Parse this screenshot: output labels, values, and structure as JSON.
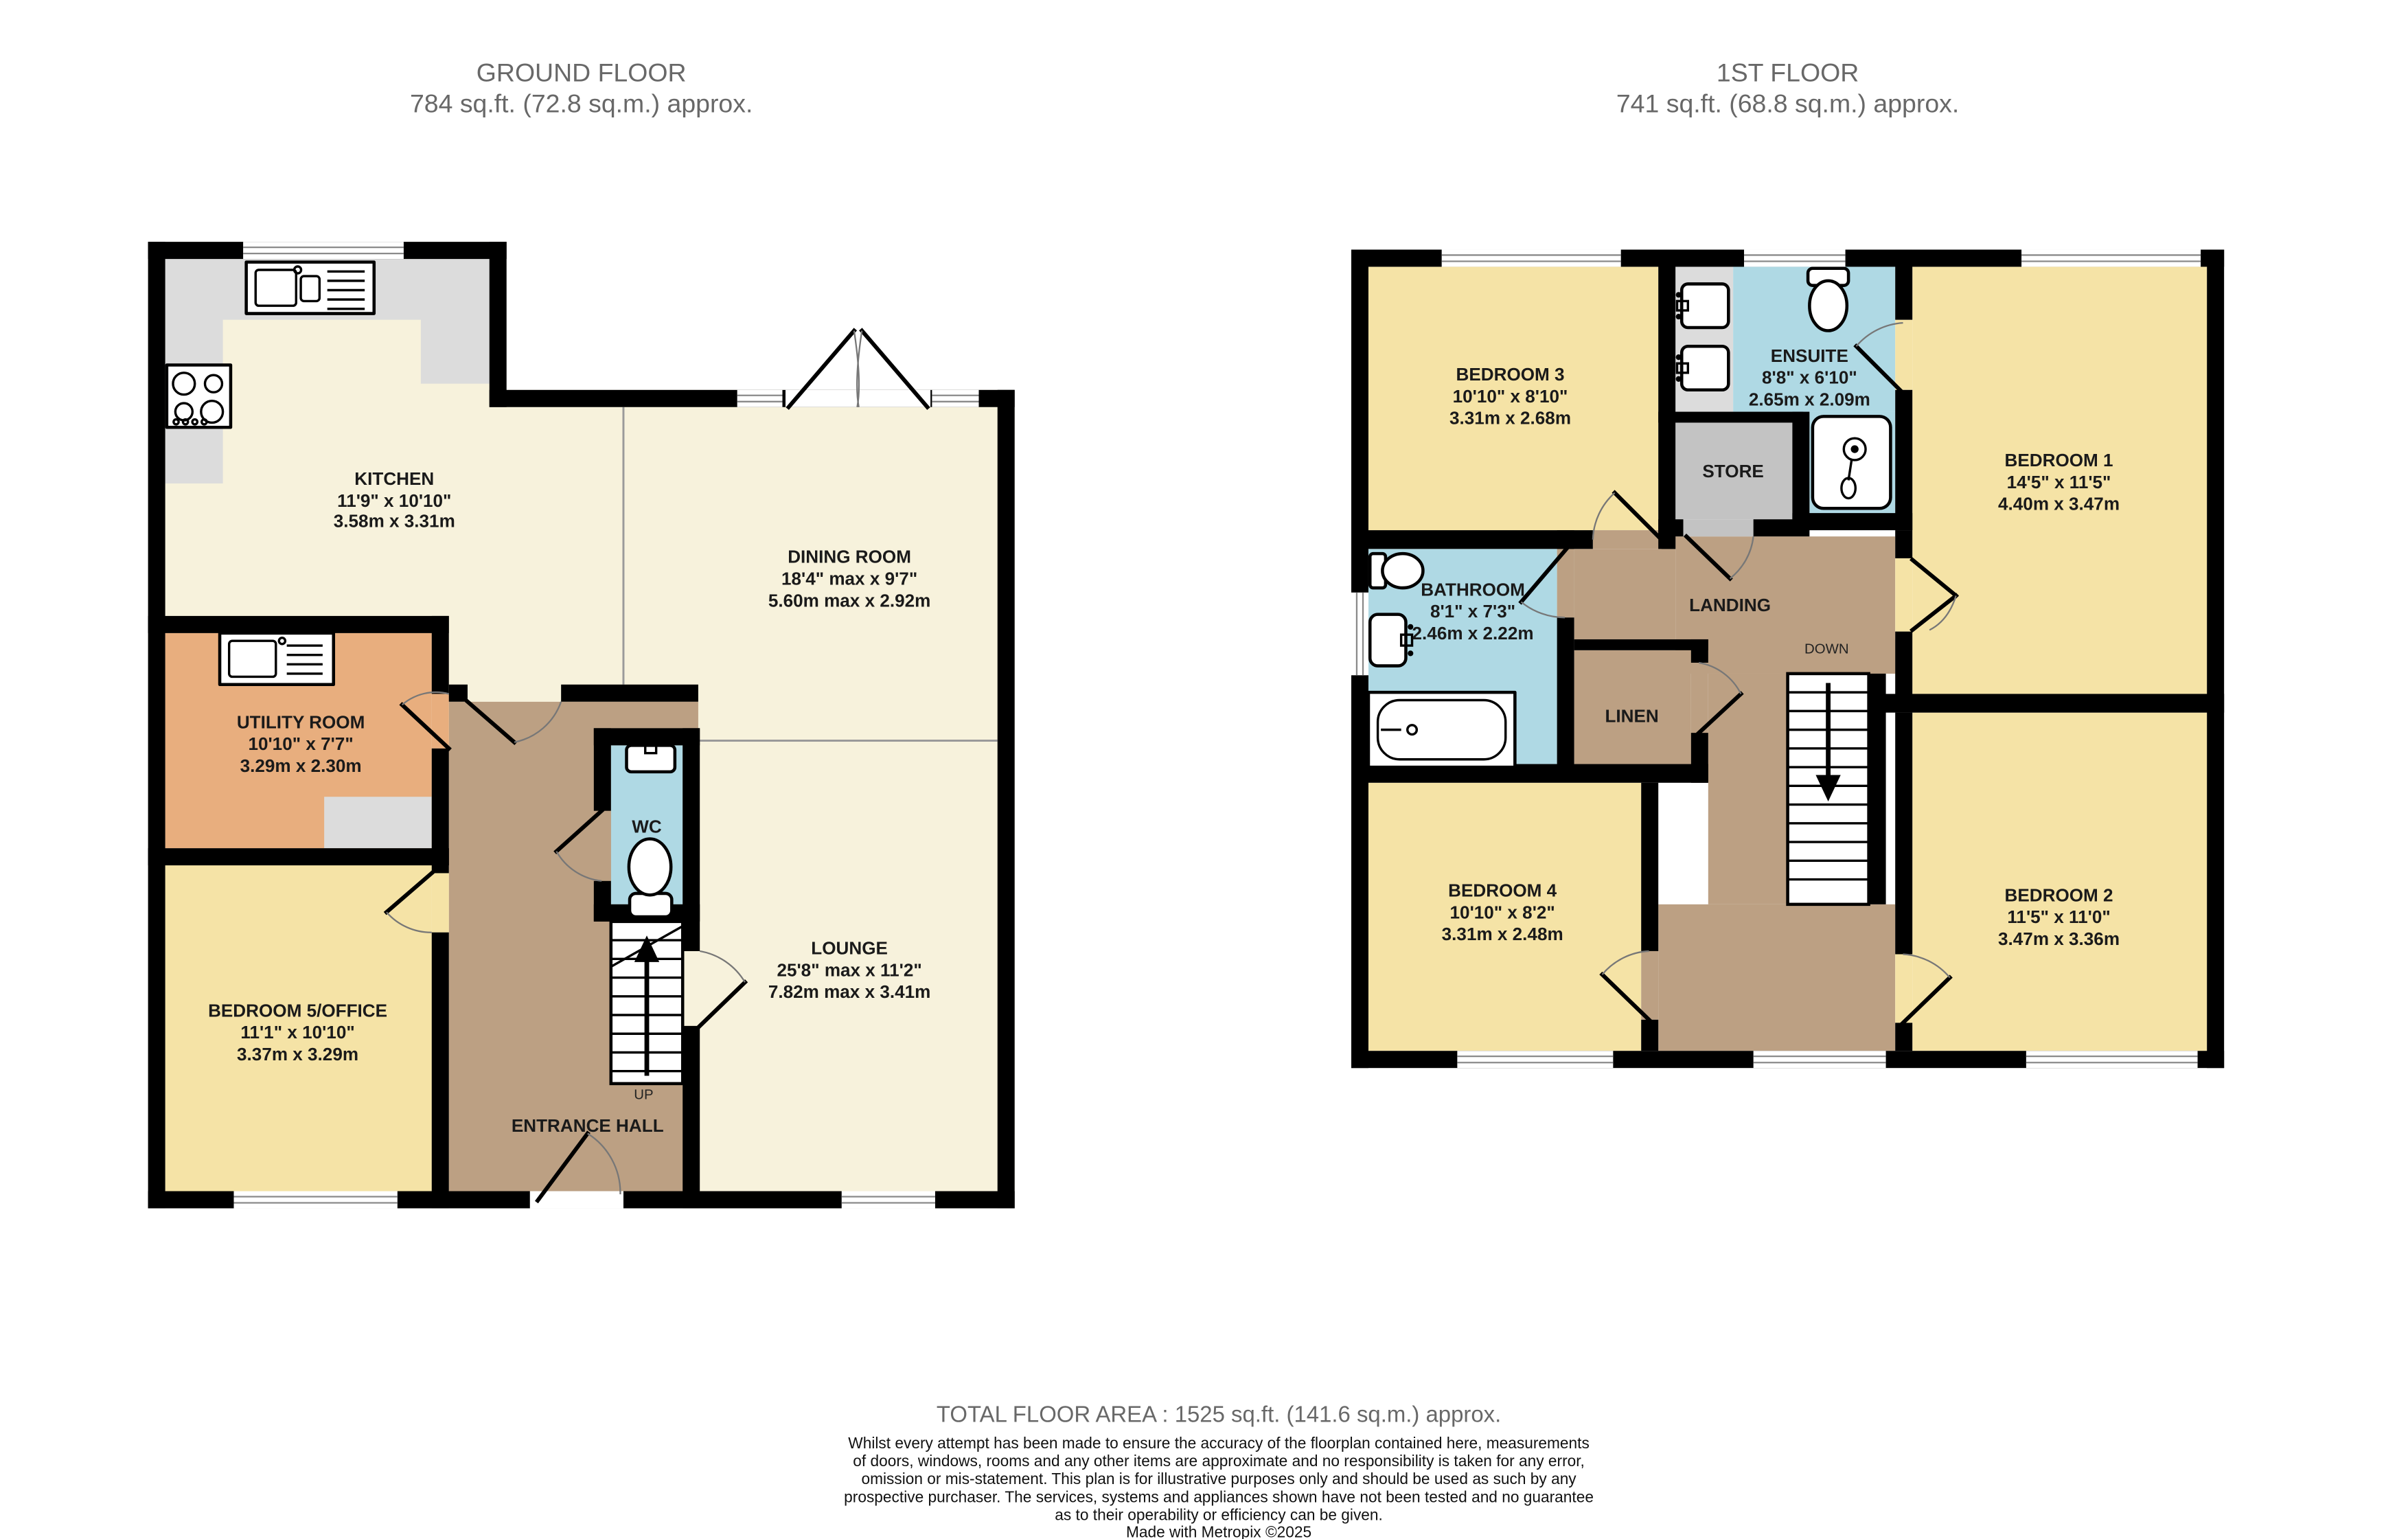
{
  "ground": {
    "title": "GROUND FLOOR",
    "area": "784 sq.ft. (72.8 sq.m.) approx.",
    "rooms": {
      "kitchen": {
        "name": "KITCHEN",
        "imperial": "11'9\"  x 10'10\"",
        "metric": "3.58m  x 3.31m"
      },
      "dining": {
        "name": "DINING ROOM",
        "imperial": "18'4\" max x 9'7\"",
        "metric": "5.60m max x 2.92m"
      },
      "utility": {
        "name": "UTILITY ROOM",
        "imperial": "10'10\"  x 7'7\"",
        "metric": "3.29m  x 2.30m"
      },
      "bedroom5": {
        "name": "BEDROOM 5/OFFICE",
        "imperial": "11'1\"  x 10'10\"",
        "metric": "3.37m  x 3.29m"
      },
      "lounge": {
        "name": "LOUNGE",
        "imperial": "25'8\" max x 11'2\"",
        "metric": "7.82m max x 3.41m"
      },
      "hall": {
        "name": "ENTRANCE HALL"
      },
      "wc": {
        "name": "WC"
      },
      "up": "UP"
    }
  },
  "first": {
    "title": "1ST FLOOR",
    "area": "741 sq.ft. (68.8 sq.m.) approx.",
    "rooms": {
      "bedroom3": {
        "name": "BEDROOM 3",
        "imperial": "10'10\"  x 8'10\"",
        "metric": "3.31m  x 2.68m"
      },
      "ensuite": {
        "name": "ENSUITE",
        "imperial": "8'8\"  x 6'10\"",
        "metric": "2.65m  x 2.09m"
      },
      "bedroom1": {
        "name": "BEDROOM 1",
        "imperial": "14'5\"  x 11'5\"",
        "metric": "4.40m  x 3.47m"
      },
      "bathroom": {
        "name": "BATHROOM",
        "imperial": "8'1\"  x 7'3\"",
        "metric": "2.46m  x 2.22m"
      },
      "landing": {
        "name": "LANDING"
      },
      "linen": {
        "name": "LINEN"
      },
      "store": {
        "name": "STORE"
      },
      "bedroom4": {
        "name": "BEDROOM 4",
        "imperial": "10'10\"  x 8'2\"",
        "metric": "3.31m  x 2.48m"
      },
      "bedroom2": {
        "name": "BEDROOM 2",
        "imperial": "11'5\"  x 11'0\"",
        "metric": "3.47m  x 3.36m"
      },
      "down": "DOWN"
    }
  },
  "footer": {
    "total": "TOTAL FLOOR AREA : 1525 sq.ft. (141.6 sq.m.) approx.",
    "disclaimer": [
      "Whilst every attempt has been made to ensure the accuracy of the floorplan contained here, measurements",
      "of doors, windows, rooms and any other items are approximate and no responsibility is taken for any error,",
      "omission or mis-statement. This plan is for illustrative purposes only and should be used as such by any",
      "prospective purchaser. The services, systems and appliances shown have not been tested and no guarantee",
      "as to their operability or efficiency can be given.",
      "Made with Metropix ©2025"
    ]
  },
  "colors": {
    "wall": "#000000",
    "floor": "#F7F2DC",
    "bedroom": "#F5E3A6",
    "utility": "#E8AE7E",
    "hallway": "#BCA083",
    "wet_room": "#AFD9E4",
    "store": "#C3C3C3",
    "counter": "#DCDCDC"
  }
}
